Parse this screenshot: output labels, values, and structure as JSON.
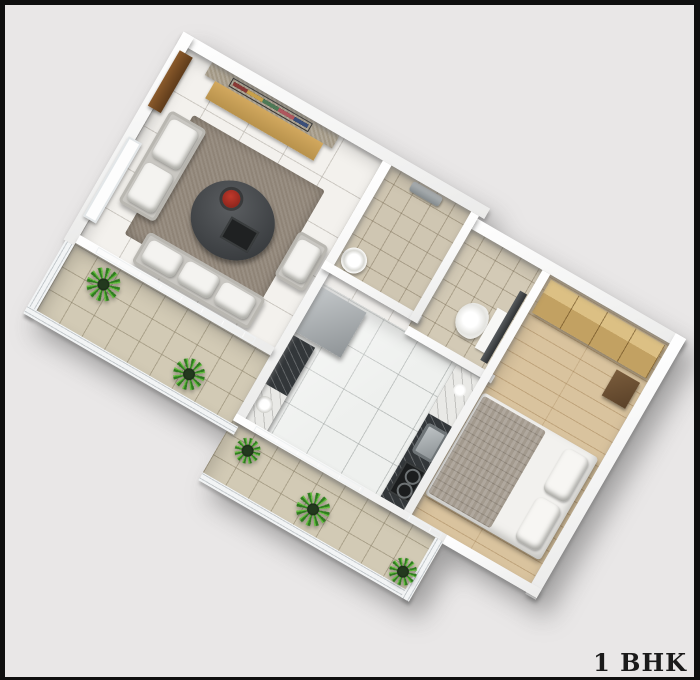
{
  "canvas": {
    "background_color": "#e9e7e7",
    "frame_color": "#0f0f0f"
  },
  "label": {
    "text": "1 BHK",
    "color": "#1a1a1a"
  },
  "floor_plan": {
    "type": "3d-isometric-floor-plan-render",
    "unit_type": "1 BHK apartment",
    "rooms": [
      {
        "name": "living-room",
        "floor": "white tiles",
        "floor_color": "#f3f1ed",
        "items": [
          "entry-door",
          "window",
          "tv-accent-wall",
          "tv",
          "tv-cabinet",
          "area-rug",
          "two-seater-sofa",
          "three-seater-sofa",
          "armchair",
          "coffee-table",
          "flower-vase",
          "tray"
        ]
      },
      {
        "name": "bathroom",
        "floor": "beige tiles",
        "floor_color": "#cfc6b2",
        "items": [
          "shower-mixer",
          "washbasin"
        ]
      },
      {
        "name": "toilet",
        "floor": "beige tiles",
        "floor_color": "#d3cab6",
        "items": [
          "wc-pan",
          "flush-tank",
          "door-panel"
        ]
      },
      {
        "name": "kitchen",
        "floor": "glossy white tiles",
        "floor_color": "#eef0ee",
        "items": [
          "refrigerator",
          "granite-counter-left",
          "granite-counter-right",
          "marble-slab",
          "plate",
          "jar",
          "sink",
          "hob"
        ]
      },
      {
        "name": "bedroom",
        "floor": "wood laminate",
        "floor_color": "#d9c39e",
        "items": [
          "wardrobe",
          "double-bed",
          "blanket",
          "pillows",
          "bedside-unit"
        ]
      },
      {
        "name": "living-balcony",
        "floor": "stone tiles",
        "floor_color": "#d2cab5",
        "items": [
          "railing",
          "sliding-glass-door",
          "potted-plant",
          "potted-plant"
        ]
      },
      {
        "name": "rear-balcony",
        "floor": "stone tiles",
        "floor_color": "#d2cab5",
        "items": [
          "railing",
          "sliding-glass-door",
          "potted-plant",
          "potted-plant",
          "potted-plant"
        ]
      }
    ],
    "colors": {
      "walls": "#fafafa",
      "granite_counter": "#33373a",
      "marble": "#e9e9e6",
      "tv_cabinet_wood": "#c59a55",
      "wardrobe_wood": "#c9a96b",
      "sofa_fabric": "#c9c7c2",
      "cushions": "#f4f3f0",
      "rug": "#8f8477",
      "entry_door": "#7a4a22",
      "plant_green": "#63bd3e",
      "glass": "#b9c6cc",
      "blanket": "#a39a8e"
    }
  }
}
